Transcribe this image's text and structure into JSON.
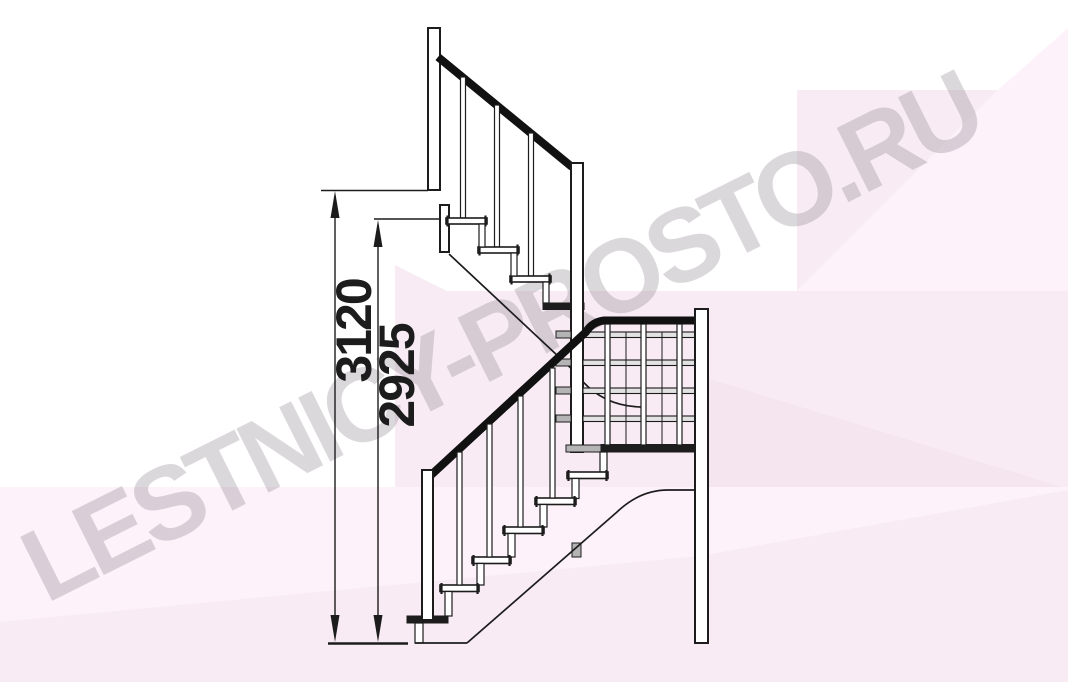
{
  "document": {
    "type": "staircase side-view technical drawing",
    "background_color": "#ffffff",
    "ink_color": "#1c1c1c"
  },
  "watermark": {
    "text": "LESTNICY-PROSTO.RU",
    "text_color": "#8a7f8a",
    "pink_light": "#fdf2f9",
    "pink_mid": "#f8ebf4",
    "pink_dark": "#f4e5ef"
  },
  "dimensions": {
    "overall_rise": "3120",
    "upper_rise": "2925"
  }
}
